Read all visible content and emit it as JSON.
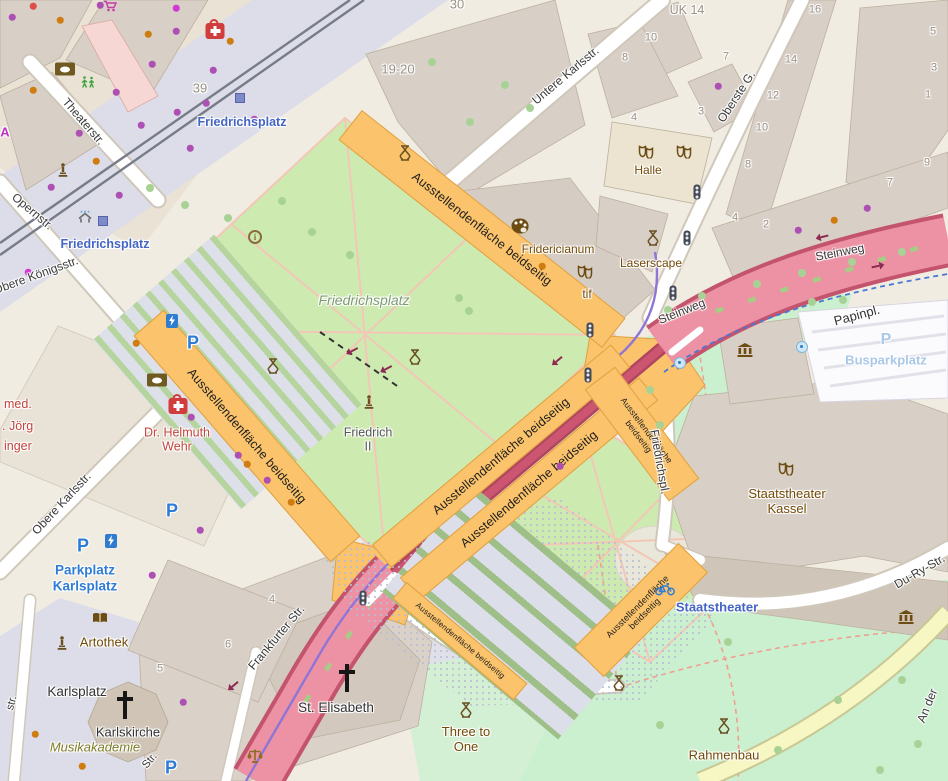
{
  "map": {
    "highlight_text": "Ausstellendenfläche beidseitig",
    "colors": {
      "band": "#fac36c",
      "band_border": "#e1a041",
      "road_pink": "#ec92a4",
      "road_casing": "#c4536e",
      "lawn": "#cdebb0",
      "park": "#cbf0cf",
      "pedestrian": "#dcdde8",
      "building": "#d8cfc6",
      "transit_blue": "#4565c4",
      "parking_blue": "#2f7cd6",
      "poi_brown": "#734a08"
    },
    "bands": [
      {
        "x": 482,
        "y": 229,
        "w": 336,
        "h": 38,
        "rot": 38.3,
        "fs": 12.5,
        "lines": 1
      },
      {
        "x": 247,
        "y": 436,
        "w": 300,
        "h": 40,
        "rot": 49,
        "fs": 12.5,
        "lines": 1
      },
      {
        "x": 501,
        "y": 456,
        "w": 312,
        "h": 30,
        "rot": -40,
        "fs": 12.5,
        "lines": 1
      },
      {
        "x": 529,
        "y": 489,
        "w": 312,
        "h": 30,
        "rot": -40,
        "fs": 12.5,
        "lines": 1
      },
      {
        "x": 642,
        "y": 434,
        "w": 140,
        "h": 38,
        "rot": 53,
        "fs": 8.5,
        "lines": 2
      },
      {
        "x": 641,
        "y": 610,
        "w": 148,
        "h": 42,
        "rot": -45,
        "fs": 9,
        "lines": 2
      },
      {
        "x": 460,
        "y": 641,
        "w": 158,
        "h": 22,
        "rot": 40,
        "fs": 8,
        "lines": 1
      }
    ],
    "labels": [
      {
        "t": "Theaterstr.",
        "x": 83,
        "y": 122,
        "r": 49,
        "k": "street"
      },
      {
        "t": "Opernstr.",
        "x": 32,
        "y": 212,
        "r": 40,
        "k": "street"
      },
      {
        "t": "Obere Königsstr.",
        "x": 36,
        "y": 276,
        "r": -20,
        "k": "street"
      },
      {
        "t": "Obere Karlsstr.",
        "x": 62,
        "y": 504,
        "r": -47,
        "k": "street"
      },
      {
        "t": "Untere Karlsstr.",
        "x": 566,
        "y": 76,
        "r": -40,
        "k": "street"
      },
      {
        "t": "Oberste G.",
        "x": 737,
        "y": 97,
        "r": -57,
        "k": "street"
      },
      {
        "t": "Steinweg",
        "x": 840,
        "y": 253,
        "r": -11,
        "k": "street"
      },
      {
        "t": "Steinweg",
        "x": 682,
        "y": 312,
        "r": -22,
        "k": "street"
      },
      {
        "t": "Frankfurter Str.",
        "x": 277,
        "y": 638,
        "r": -50,
        "k": "street"
      },
      {
        "t": "Du-Ry-Str.",
        "x": 920,
        "y": 572,
        "r": -30,
        "k": "street"
      },
      {
        "t": "An der",
        "x": 928,
        "y": 706,
        "r": -68,
        "k": "street"
      },
      {
        "t": "Friedrichspl.",
        "x": 659,
        "y": 462,
        "r": 80,
        "k": "street"
      },
      {
        "t": "str.",
        "x": 12,
        "y": 703,
        "r": -75,
        "k": "streetp"
      },
      {
        "t": "Str.",
        "x": 150,
        "y": 761,
        "r": -50,
        "k": "streetp"
      },
      {
        "t": "Fridericianum",
        "x": 558,
        "y": 250,
        "k": "place"
      },
      {
        "t": "Laserscape",
        "x": 651,
        "y": 264,
        "k": "place"
      },
      {
        "t": "tif",
        "x": 587,
        "y": 295,
        "k": "place"
      },
      {
        "t": "Halle",
        "x": 648,
        "y": 171,
        "k": "place"
      },
      {
        "t": "Staatstheater\nKassel",
        "x": 787,
        "y": 502,
        "k": "place",
        "s": 13
      },
      {
        "t": "Three to\nOne",
        "x": 466,
        "y": 740,
        "k": "place",
        "s": 13
      },
      {
        "t": "Rahmenbau",
        "x": 724,
        "y": 756,
        "k": "place",
        "s": 13
      },
      {
        "t": "Artothek",
        "x": 104,
        "y": 643,
        "k": "place",
        "s": 13
      },
      {
        "t": "Papinpl.",
        "x": 857,
        "y": 316,
        "r": -15,
        "k": "dark"
      },
      {
        "t": "Karlsplatz",
        "x": 77,
        "y": 692,
        "k": "dark",
        "s": 13.5
      },
      {
        "t": "Karlskirche",
        "x": 128,
        "y": 733,
        "k": "dark"
      },
      {
        "t": "St. Elisabeth",
        "x": 336,
        "y": 708,
        "k": "dark",
        "s": 13.5
      },
      {
        "t": "Musikakademie",
        "x": 95,
        "y": 748,
        "k": "olive"
      },
      {
        "t": "Friedrichsplatz",
        "x": 364,
        "y": 300,
        "k": "park"
      },
      {
        "t": "Friedrich\nII",
        "x": 368,
        "y": 440,
        "k": "gray"
      },
      {
        "t": "Dr. Helmuth\nWehr",
        "x": 177,
        "y": 440,
        "k": "health"
      },
      {
        "t": "med.",
        "x": 4,
        "y": 404,
        "k": "health",
        "a": "l"
      },
      {
        "t": ". Jörg",
        "x": 2,
        "y": 426,
        "k": "health",
        "a": "l"
      },
      {
        "t": "inger",
        "x": 4,
        "y": 446,
        "k": "health",
        "a": "l"
      },
      {
        "t": "UK 14",
        "x": 687,
        "y": 10,
        "k": "num",
        "s": 12.5
      },
      {
        "t": "A",
        "x": 5,
        "y": 133,
        "k": "magenta"
      },
      {
        "t": "Friedrichsplatz",
        "x": 242,
        "y": 122,
        "k": "transit"
      },
      {
        "t": "Friedrichsplatz",
        "x": 105,
        "y": 244,
        "k": "transit"
      },
      {
        "t": "Staatstheater",
        "x": 717,
        "y": 608,
        "k": "transit",
        "s": 13
      },
      {
        "t": "Parkplatz\nKarlsplatz",
        "x": 85,
        "y": 578,
        "k": "parkblue"
      },
      {
        "t": "Busparkplatz",
        "x": 886,
        "y": 361,
        "k": "parkpale"
      },
      {
        "t": "39",
        "x": 200,
        "y": 89,
        "k": "num",
        "s": 13
      },
      {
        "t": "19-20",
        "x": 398,
        "y": 70,
        "k": "num",
        "s": 13
      },
      {
        "t": "30",
        "x": 457,
        "y": 5,
        "k": "num",
        "s": 13
      },
      {
        "t": "10",
        "x": 651,
        "y": 38,
        "k": "num"
      },
      {
        "t": "7",
        "x": 726,
        "y": 57,
        "k": "num"
      },
      {
        "t": "3",
        "x": 701,
        "y": 112,
        "k": "num"
      },
      {
        "t": "8",
        "x": 625,
        "y": 58,
        "k": "num"
      },
      {
        "t": "4",
        "x": 634,
        "y": 118,
        "k": "num"
      },
      {
        "t": "16",
        "x": 815,
        "y": 10,
        "k": "num"
      },
      {
        "t": "14",
        "x": 791,
        "y": 60,
        "k": "num"
      },
      {
        "t": "12",
        "x": 773,
        "y": 96,
        "k": "num"
      },
      {
        "t": "10",
        "x": 762,
        "y": 128,
        "k": "num"
      },
      {
        "t": "8",
        "x": 748,
        "y": 165,
        "k": "num"
      },
      {
        "t": "4",
        "x": 735,
        "y": 218,
        "k": "num"
      },
      {
        "t": "2",
        "x": 766,
        "y": 225,
        "k": "num"
      },
      {
        "t": "5",
        "x": 933,
        "y": 32,
        "k": "num"
      },
      {
        "t": "3",
        "x": 934,
        "y": 68,
        "k": "num"
      },
      {
        "t": "1",
        "x": 928,
        "y": 95,
        "k": "num"
      },
      {
        "t": "9",
        "x": 927,
        "y": 163,
        "k": "num"
      },
      {
        "t": "7",
        "x": 890,
        "y": 183,
        "k": "num"
      },
      {
        "t": "4",
        "x": 272,
        "y": 600,
        "k": "num"
      },
      {
        "t": "6",
        "x": 228,
        "y": 645,
        "k": "num"
      },
      {
        "t": "5",
        "x": 160,
        "y": 669,
        "k": "num"
      }
    ],
    "icons": [
      {
        "t": "firstaid",
        "x": 215,
        "y": 31
      },
      {
        "t": "firstaid",
        "x": 178,
        "y": 406
      },
      {
        "t": "bank",
        "x": 65,
        "y": 69
      },
      {
        "t": "bank",
        "x": 157,
        "y": 380
      },
      {
        "t": "palette",
        "x": 520,
        "y": 226
      },
      {
        "t": "masks",
        "x": 646,
        "y": 152
      },
      {
        "t": "masks",
        "x": 684,
        "y": 152
      },
      {
        "t": "masks",
        "x": 585,
        "y": 272
      },
      {
        "t": "masks",
        "x": 786,
        "y": 469
      },
      {
        "t": "museum",
        "x": 745,
        "y": 350
      },
      {
        "t": "museum",
        "x": 906,
        "y": 617
      },
      {
        "t": "monument",
        "x": 405,
        "y": 153
      },
      {
        "t": "monument",
        "x": 415,
        "y": 357
      },
      {
        "t": "monument",
        "x": 273,
        "y": 366
      },
      {
        "t": "monument",
        "x": 466,
        "y": 710
      },
      {
        "t": "monument",
        "x": 619,
        "y": 683
      },
      {
        "t": "monument",
        "x": 724,
        "y": 726
      },
      {
        "t": "monument",
        "x": 653,
        "y": 238
      },
      {
        "t": "statue",
        "x": 63,
        "y": 170
      },
      {
        "t": "statue",
        "x": 369,
        "y": 402
      },
      {
        "t": "statue",
        "x": 62,
        "y": 643
      },
      {
        "t": "info",
        "x": 255,
        "y": 237
      },
      {
        "t": "fountain",
        "x": 680,
        "y": 363
      },
      {
        "t": "fountain",
        "x": 802,
        "y": 347
      },
      {
        "t": "tram",
        "x": 240,
        "y": 98
      },
      {
        "t": "tram",
        "x": 103,
        "y": 221
      },
      {
        "t": "shelter",
        "x": 85,
        "y": 217
      },
      {
        "t": "light",
        "x": 697,
        "y": 192
      },
      {
        "t": "light",
        "x": 687,
        "y": 238
      },
      {
        "t": "light",
        "x": 673,
        "y": 293
      },
      {
        "t": "light",
        "x": 590,
        "y": 330
      },
      {
        "t": "light",
        "x": 588,
        "y": 375
      },
      {
        "t": "light",
        "x": 363,
        "y": 598
      },
      {
        "t": "p",
        "x": 193,
        "y": 343
      },
      {
        "t": "p",
        "x": 172,
        "y": 511
      },
      {
        "t": "p",
        "x": 83,
        "y": 546
      },
      {
        "t": "p",
        "x": 171,
        "y": 768
      },
      {
        "t": "ppale",
        "x": 886,
        "y": 340
      },
      {
        "t": "ev",
        "x": 172,
        "y": 321
      },
      {
        "t": "ev",
        "x": 111,
        "y": 541
      },
      {
        "t": "bike",
        "x": 665,
        "y": 589
      },
      {
        "t": "book",
        "x": 100,
        "y": 618
      },
      {
        "t": "scales",
        "x": 255,
        "y": 756
      },
      {
        "t": "cross",
        "x": 125,
        "y": 705
      },
      {
        "t": "cross",
        "x": 347,
        "y": 678
      },
      {
        "t": "figures",
        "x": 88,
        "y": 82
      },
      {
        "t": "cart",
        "x": 110,
        "y": 6
      },
      {
        "t": "arrow",
        "x": 822,
        "y": 237,
        "r": 166
      },
      {
        "t": "arrow",
        "x": 878,
        "y": 266,
        "r": -12
      },
      {
        "t": "arrow",
        "x": 557,
        "y": 361,
        "r": 140
      },
      {
        "t": "arrow",
        "x": 233,
        "y": 686,
        "r": 140
      },
      {
        "t": "arrow",
        "x": 352,
        "y": 351,
        "r": 152
      },
      {
        "t": "arrow",
        "x": 386,
        "y": 369,
        "r": 152
      }
    ],
    "dots": [
      [
        "p",
        12,
        17
      ],
      [
        "r",
        33,
        6
      ],
      [
        "o",
        60,
        20
      ],
      [
        "m",
        176,
        8
      ],
      [
        "p",
        100,
        5
      ],
      [
        "o",
        148,
        34
      ],
      [
        "p",
        176,
        31
      ],
      [
        "p",
        116,
        92
      ],
      [
        "p",
        141,
        125
      ],
      [
        "p",
        79,
        133
      ],
      [
        "p",
        177,
        112
      ],
      [
        "p",
        206,
        103
      ],
      [
        "o",
        230,
        41
      ],
      [
        "p",
        152,
        64
      ],
      [
        "p",
        213,
        70
      ],
      [
        "o",
        33,
        90
      ],
      [
        "o",
        96,
        161
      ],
      [
        "p",
        190,
        148
      ],
      [
        "p",
        119,
        195
      ],
      [
        "p",
        88,
        245
      ],
      [
        "p",
        51,
        187
      ],
      [
        "p",
        254,
        119
      ],
      [
        "m",
        28,
        272
      ],
      [
        "o",
        136,
        343
      ],
      [
        "p",
        191,
        417
      ],
      [
        "p",
        238,
        455
      ],
      [
        "o",
        247,
        464
      ],
      [
        "p",
        267,
        480
      ],
      [
        "o",
        291,
        502
      ],
      [
        "p",
        200,
        530
      ],
      [
        "p",
        152,
        575
      ],
      [
        "p",
        183,
        702
      ],
      [
        "o",
        35,
        734
      ],
      [
        "o",
        82,
        766
      ],
      [
        "p",
        560,
        466
      ],
      [
        "p",
        798,
        230
      ],
      [
        "o",
        834,
        220
      ],
      [
        "p",
        867,
        208
      ],
      [
        "p",
        718,
        86
      ],
      [
        "o",
        542,
        266
      ],
      [
        "g",
        150,
        188
      ],
      [
        "g",
        185,
        205
      ],
      [
        "g",
        228,
        218
      ],
      [
        "g",
        282,
        201
      ],
      [
        "g",
        312,
        232
      ],
      [
        "g",
        350,
        255
      ],
      [
        "g",
        505,
        85
      ],
      [
        "g",
        530,
        108
      ],
      [
        "g",
        470,
        122
      ],
      [
        "g",
        432,
        62
      ],
      [
        "g",
        459,
        298
      ],
      [
        "g",
        469,
        311
      ],
      [
        "g",
        668,
        310
      ],
      [
        "g",
        702,
        296
      ],
      [
        "g",
        812,
        302
      ],
      [
        "g",
        843,
        300
      ],
      [
        "g",
        650,
        390
      ],
      [
        "g",
        660,
        425
      ],
      [
        "g",
        728,
        642
      ],
      [
        "g",
        660,
        725
      ],
      [
        "g",
        778,
        750
      ],
      [
        "g",
        838,
        700
      ],
      [
        "g",
        902,
        680
      ],
      [
        "g",
        757,
        284
      ],
      [
        "g",
        802,
        273
      ],
      [
        "g",
        852,
        262
      ],
      [
        "g",
        902,
        252
      ],
      [
        "g",
        918,
        744
      ],
      [
        "g",
        880,
        770
      ]
    ]
  }
}
